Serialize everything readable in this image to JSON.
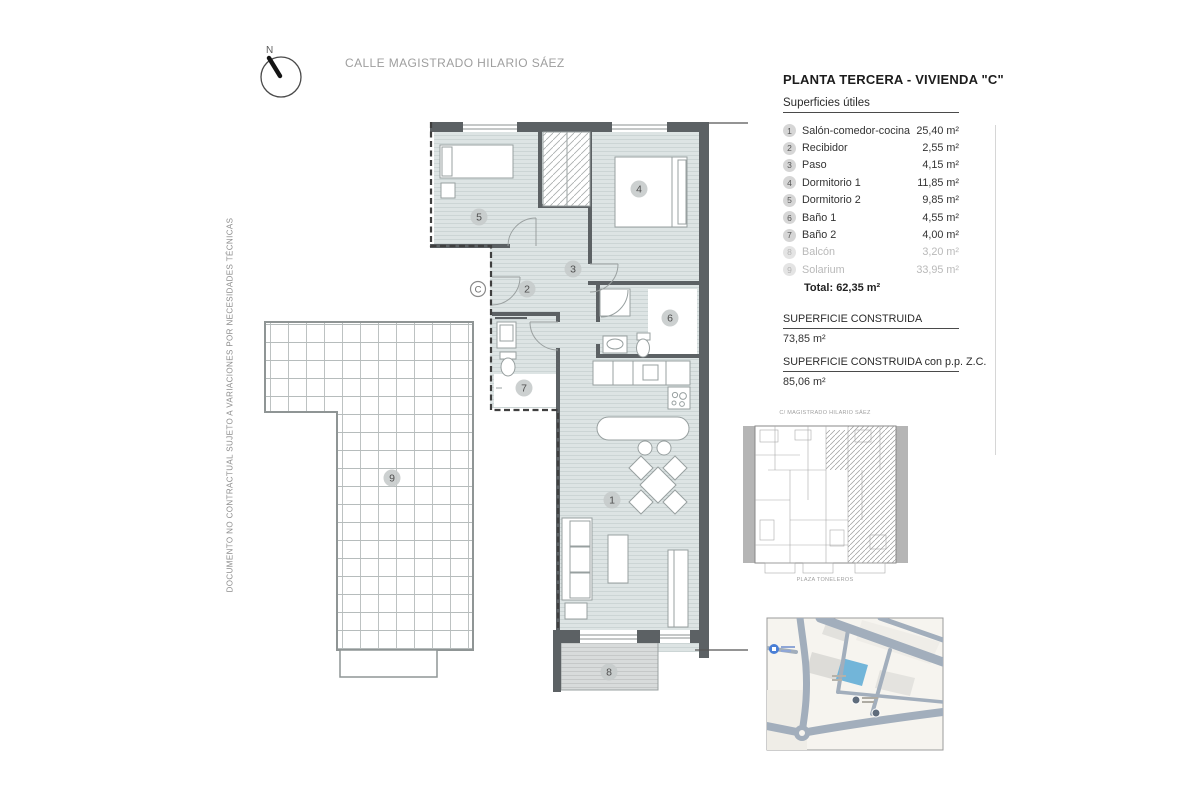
{
  "header": {
    "title": "PLANTA TERCERA - VIVIENDA \"C\"",
    "subtitle": "Superficies útiles"
  },
  "areas": {
    "rows": [
      {
        "num": "1",
        "name": "Salón-comedor-cocina",
        "value": "25,40 m²",
        "muted": false
      },
      {
        "num": "2",
        "name": "Recibidor",
        "value": "2,55 m²",
        "muted": false
      },
      {
        "num": "3",
        "name": "Paso",
        "value": "4,15 m²",
        "muted": false
      },
      {
        "num": "4",
        "name": "Dormitorio 1",
        "value": "11,85 m²",
        "muted": false
      },
      {
        "num": "5",
        "name": "Dormitorio 2",
        "value": "9,85 m²",
        "muted": false
      },
      {
        "num": "6",
        "name": "Baño 1",
        "value": "4,55 m²",
        "muted": false
      },
      {
        "num": "7",
        "name": "Baño 2",
        "value": "4,00 m²",
        "muted": false
      },
      {
        "num": "8",
        "name": "Balcón",
        "value": "3,20 m²",
        "muted": true
      },
      {
        "num": "9",
        "name": "Solarium",
        "value": "33,95 m²",
        "muted": true
      }
    ],
    "total_label": "Total:",
    "total_value": "62,35 m²"
  },
  "built": {
    "label1": "SUPERFICIE CONSTRUIDA",
    "value1": "73,85 m²",
    "label2": "SUPERFICIE CONSTRUIDA con p.p. Z.C.",
    "value2": "85,06 m²"
  },
  "annotations": {
    "street": "CALLE MAGISTRADO HILARIO SÁEZ",
    "side_note": "DOCUMENTO NO CONTRACTUAL SUJETO A VARIACIONES POR NECESIDADES TÉCNICAS",
    "compass_n": "N",
    "unit_letter": "C"
  },
  "keyplan": {
    "top_label": "C/ MAGISTRADO HILARIO SÁEZ",
    "bottom_label": "PLAZA TONELEROS"
  },
  "plan_badges": [
    "1",
    "2",
    "3",
    "4",
    "5",
    "6",
    "7",
    "8",
    "9"
  ],
  "colors": {
    "floor": "#dde4e4",
    "wall": "#5c6164",
    "balcony": "#d8dbdb",
    "map_highlight": "#72b5d9"
  }
}
